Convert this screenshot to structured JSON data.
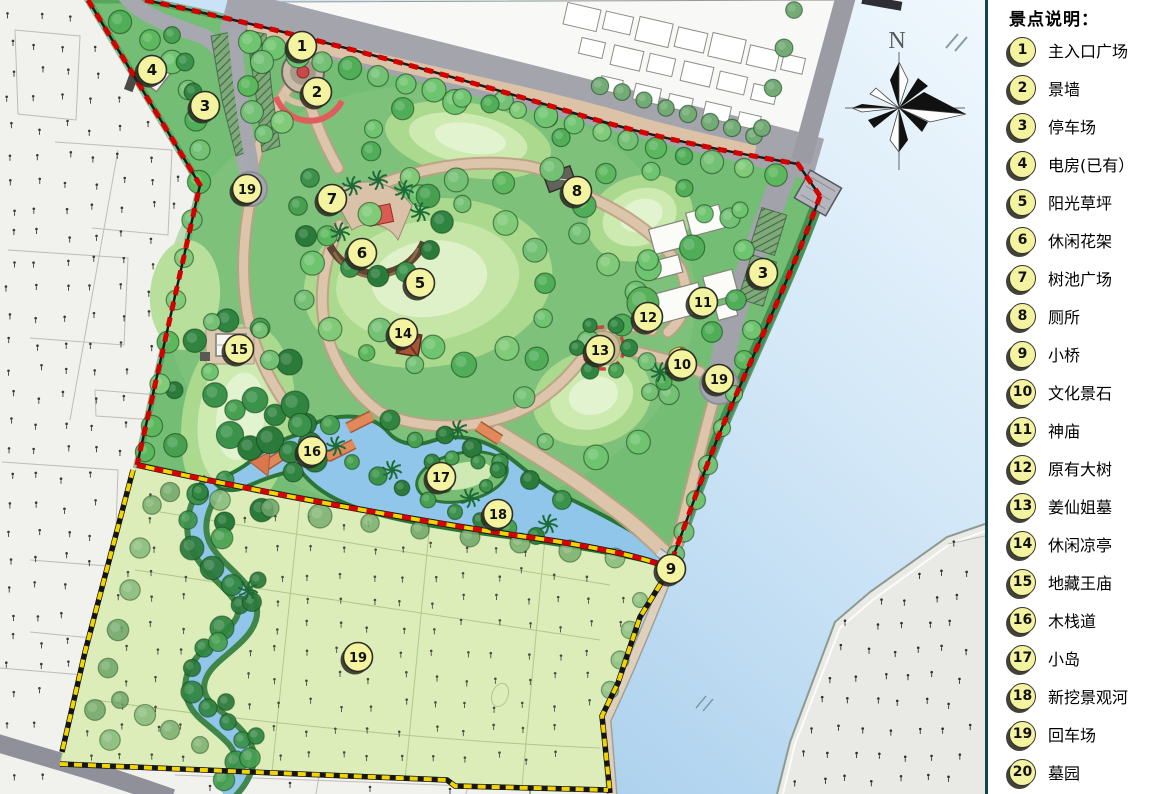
{
  "legend": {
    "title": "景点说明：",
    "items": [
      {
        "num": "1",
        "label": "主入口广场"
      },
      {
        "num": "2",
        "label": "景墙"
      },
      {
        "num": "3",
        "label": "停车场"
      },
      {
        "num": "4",
        "label": "电房(已有）"
      },
      {
        "num": "5",
        "label": "阳光草坪"
      },
      {
        "num": "6",
        "label": "休闲花架"
      },
      {
        "num": "7",
        "label": "树池广场"
      },
      {
        "num": "8",
        "label": "厕所"
      },
      {
        "num": "9",
        "label": "小桥"
      },
      {
        "num": "10",
        "label": "文化景石"
      },
      {
        "num": "11",
        "label": "神庙"
      },
      {
        "num": "12",
        "label": "原有大树"
      },
      {
        "num": "13",
        "label": "姜仙姐墓"
      },
      {
        "num": "14",
        "label": "休闲凉亭"
      },
      {
        "num": "15",
        "label": "地藏王庙"
      },
      {
        "num": "16",
        "label": "木栈道"
      },
      {
        "num": "17",
        "label": "小岛"
      },
      {
        "num": "18",
        "label": "新挖景观河"
      },
      {
        "num": "19",
        "label": "回车场"
      },
      {
        "num": "20",
        "label": "墓园"
      }
    ]
  },
  "map": {
    "compass_label": "N",
    "markers": [
      {
        "n": "1",
        "x": 302,
        "y": 46
      },
      {
        "n": "2",
        "x": 317,
        "y": 92
      },
      {
        "n": "3",
        "x": 205,
        "y": 106
      },
      {
        "n": "4",
        "x": 152,
        "y": 70
      },
      {
        "n": "19",
        "x": 247,
        "y": 189
      },
      {
        "n": "7",
        "x": 332,
        "y": 199
      },
      {
        "n": "6",
        "x": 362,
        "y": 253
      },
      {
        "n": "5",
        "x": 420,
        "y": 283
      },
      {
        "n": "8",
        "x": 577,
        "y": 191
      },
      {
        "n": "3",
        "x": 763,
        "y": 273
      },
      {
        "n": "11",
        "x": 703,
        "y": 302
      },
      {
        "n": "12",
        "x": 648,
        "y": 317
      },
      {
        "n": "13",
        "x": 600,
        "y": 350
      },
      {
        "n": "14",
        "x": 403,
        "y": 333
      },
      {
        "n": "15",
        "x": 239,
        "y": 349
      },
      {
        "n": "10",
        "x": 682,
        "y": 364
      },
      {
        "n": "19",
        "x": 719,
        "y": 379
      },
      {
        "n": "16",
        "x": 312,
        "y": 451
      },
      {
        "n": "17",
        "x": 441,
        "y": 477
      },
      {
        "n": "18",
        "x": 498,
        "y": 514
      },
      {
        "n": "9",
        "x": 671,
        "y": 569
      },
      {
        "n": "19",
        "x": 358,
        "y": 657
      }
    ]
  },
  "colors": {
    "boundary_red": "#d40000",
    "boundary_yellow": "#f2d400",
    "badge_fill": "#f4f3a0",
    "water": "#aed2ee",
    "park_green": "#74bd74",
    "lawn": "#dff1c8",
    "cemetery": "#dcedb9",
    "road_grey": "#a4a4ac",
    "path_tan": "#dcc5aa",
    "boardwalk_orange": "#e08a5c"
  }
}
